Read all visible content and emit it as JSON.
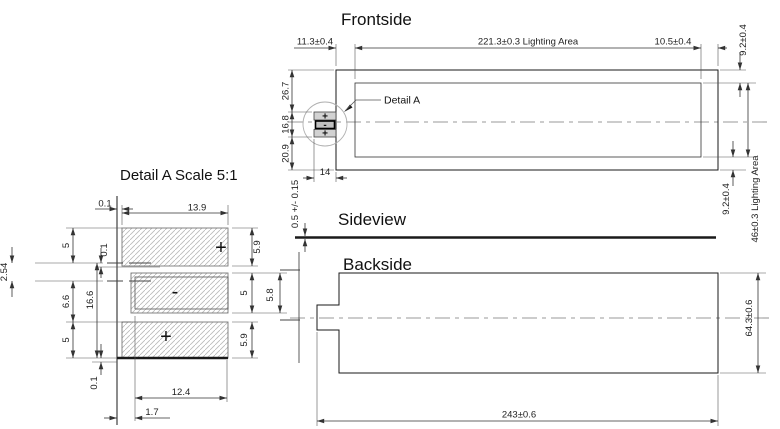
{
  "frontside": {
    "title": "Frontside",
    "detail_callout": "Detail A",
    "dims": {
      "offset_left": "11.3±0.4",
      "lighting_width": "221.3±0.3  Lighting Area",
      "offset_right": "10.5±0.4",
      "margin_top": "9.2±0.4",
      "lighting_height": "46±0.3  Lighting Area",
      "margin_bottom": "9.2±0.4",
      "upper_section": "26.7",
      "connector_height": "16.8",
      "lower_section": "20.9",
      "connector_width": "14"
    },
    "pads": {
      "top": "+",
      "middle": "-",
      "bottom": "+"
    }
  },
  "sideview": {
    "title": "Sideview",
    "dims": {
      "thickness": "0.5 +/- 0.15"
    }
  },
  "backside": {
    "title": "Backside",
    "dims": {
      "height": "64.3±0.6",
      "length": "243±0.6"
    }
  },
  "detail": {
    "title": "Detail A  Scale 5:1",
    "pads": {
      "top": "+",
      "middle": "-",
      "bottom": "+"
    },
    "dims": {
      "edge_gap_top": "0.1",
      "outer_pad_width": "13.9",
      "top_pad_height": "5.9",
      "mid_pad_height_inner": "5",
      "mid_pad_height_outer": "5.8",
      "bottom_pad_height": "5.9",
      "left_top": "5",
      "gap_upper": "0.1",
      "pitch": "2.54",
      "left_middle": "6.6",
      "total_height": "16.6",
      "left_bottom": "5",
      "gap_lower": "0.1",
      "mid_pad_width": "12.4",
      "mid_pad_offset": "1.7"
    }
  },
  "meta": {
    "colors": {
      "background": "#ffffff",
      "outline": "#1a1a1a",
      "dimension": "#333333",
      "centerline": "#9a9a9a",
      "hatch": "#b9b9b9",
      "pad_fill": "#d2d2d2"
    }
  }
}
